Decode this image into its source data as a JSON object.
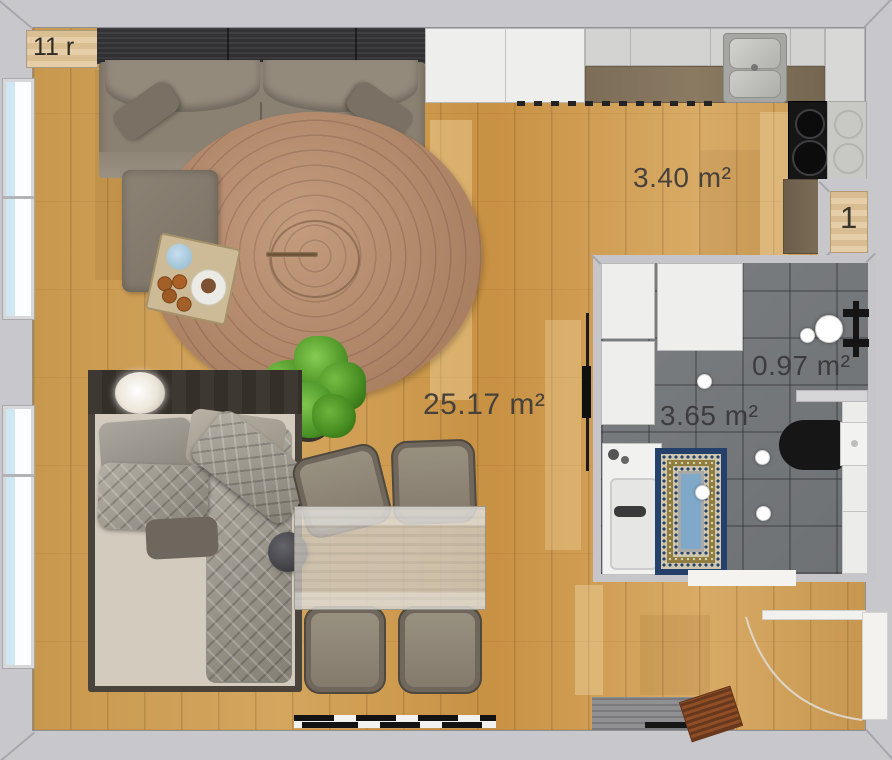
{
  "plan": {
    "tag": "11 r",
    "door_number": "1"
  },
  "labels": {
    "living_area": "25.17 m²",
    "kitchen_area": "3.40 m²",
    "shower_area": "0.97 m²",
    "bathroom_area": "3.65 m²"
  },
  "colors": {
    "wall": "#c8c8cc",
    "floor_wood": "#cfa058",
    "bathroom_tile": "#75787b",
    "round_rug": "#b48a6b",
    "bath_rug_border": "#24406b",
    "label_text": "#46413a",
    "wardrobe": "#353538",
    "counter_brown": "#7c6d57"
  }
}
